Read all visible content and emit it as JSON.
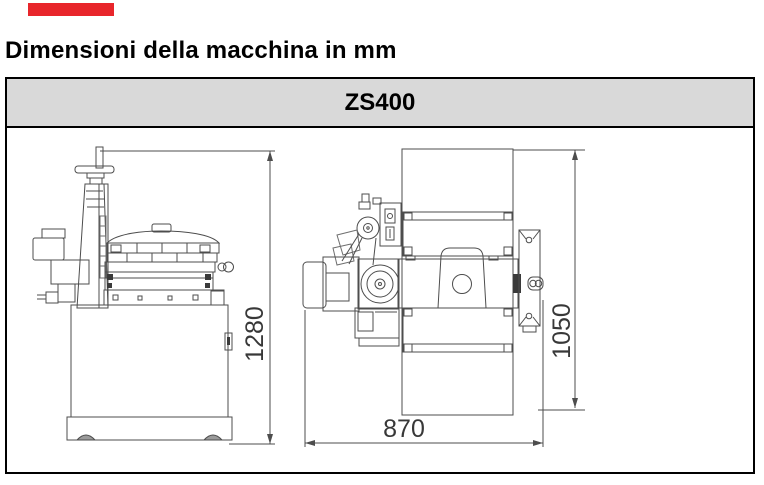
{
  "page": {
    "title": "Dimensioni della macchina in mm"
  },
  "brand_mark": {
    "color": "#e8262b"
  },
  "spec_table": {
    "header": {
      "label": "ZS400",
      "fill": "#d9d9d9",
      "border_color": "#000000"
    }
  },
  "diagram": {
    "line_color": "#4d4d4d",
    "label_color": "#383838",
    "dimensions": {
      "height": "1280",
      "depth": "1050",
      "width": "870"
    }
  }
}
